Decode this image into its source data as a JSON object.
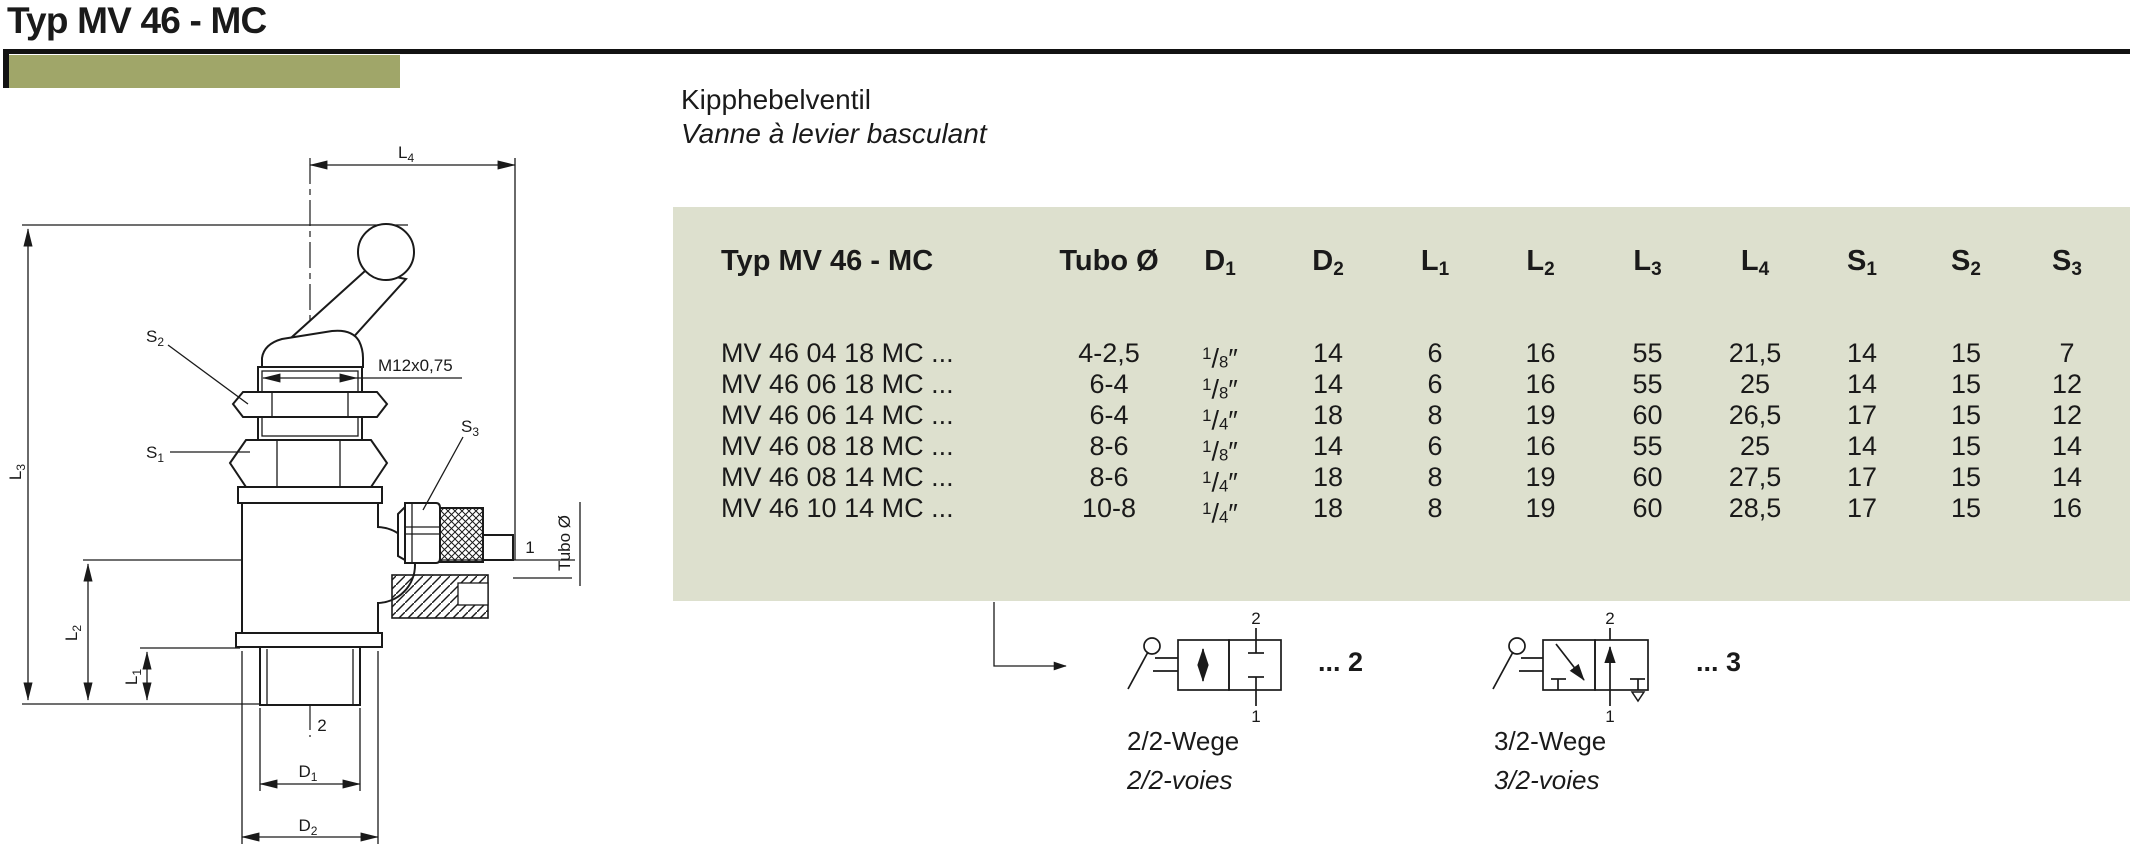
{
  "page": {
    "title": "Typ MV 46 - MC"
  },
  "subtitle": {
    "de": "Kipphebelventil",
    "fr": "Vanne à levier basculant"
  },
  "colors": {
    "accent": "#a0a669",
    "table_bg": "#dde0ce",
    "ink": "#1a1a1a"
  },
  "table": {
    "title": "Typ MV 46 - MC",
    "columns": [
      {
        "label": "Tubo Ø",
        "sub": ""
      },
      {
        "label": "D",
        "sub": "1"
      },
      {
        "label": "D",
        "sub": "2"
      },
      {
        "label": "L",
        "sub": "1"
      },
      {
        "label": "L",
        "sub": "2"
      },
      {
        "label": "L",
        "sub": "3"
      },
      {
        "label": "L",
        "sub": "4"
      },
      {
        "label": "S",
        "sub": "1"
      },
      {
        "label": "S",
        "sub": "2"
      },
      {
        "label": "S",
        "sub": "3"
      }
    ],
    "rows": [
      {
        "code": "MV 46 04 18 MC ...",
        "tubo": "4-2,5",
        "d1": {
          "num": "1",
          "den": "8",
          "unit": "″"
        },
        "d2": "14",
        "l1": "6",
        "l2": "16",
        "l3": "55",
        "l4": "21,5",
        "s1": "14",
        "s2": "15",
        "s3": "7"
      },
      {
        "code": "MV 46 06 18 MC ...",
        "tubo": "6-4",
        "d1": {
          "num": "1",
          "den": "8",
          "unit": "″"
        },
        "d2": "14",
        "l1": "6",
        "l2": "16",
        "l3": "55",
        "l4": "25",
        "s1": "14",
        "s2": "15",
        "s3": "12"
      },
      {
        "code": "MV 46 06 14 MC ...",
        "tubo": "6-4",
        "d1": {
          "num": "1",
          "den": "4",
          "unit": "″"
        },
        "d2": "18",
        "l1": "8",
        "l2": "19",
        "l3": "60",
        "l4": "26,5",
        "s1": "17",
        "s2": "15",
        "s3": "12"
      },
      {
        "code": "MV 46 08 18 MC ...",
        "tubo": "8-6",
        "d1": {
          "num": "1",
          "den": "8",
          "unit": "″"
        },
        "d2": "14",
        "l1": "6",
        "l2": "16",
        "l3": "55",
        "l4": "25",
        "s1": "14",
        "s2": "15",
        "s3": "14"
      },
      {
        "code": "MV 46 08 14 MC ...",
        "tubo": "8-6",
        "d1": {
          "num": "1",
          "den": "4",
          "unit": "″"
        },
        "d2": "18",
        "l1": "8",
        "l2": "19",
        "l3": "60",
        "l4": "27,5",
        "s1": "17",
        "s2": "15",
        "s3": "14"
      },
      {
        "code": "MV 46 10 14 MC ...",
        "tubo": "10-8",
        "d1": {
          "num": "1",
          "den": "4",
          "unit": "″"
        },
        "d2": "18",
        "l1": "8",
        "l2": "19",
        "l3": "60",
        "l4": "28,5",
        "s1": "17",
        "s2": "15",
        "s3": "16"
      }
    ]
  },
  "drawing": {
    "dims": {
      "l4": {
        "base": "L",
        "sub": "4"
      },
      "l3": {
        "base": "L",
        "sub": "3"
      },
      "l2": {
        "base": "L",
        "sub": "2"
      },
      "l1": {
        "base": "L",
        "sub": "1"
      },
      "d1": {
        "base": "D",
        "sub": "1"
      },
      "d2": {
        "base": "D",
        "sub": "2"
      },
      "s1": {
        "base": "S",
        "sub": "1"
      },
      "s2": {
        "base": "S",
        "sub": "2"
      },
      "s3": {
        "base": "S",
        "sub": "3"
      },
      "thread": "M12x0,75",
      "tubo": "Tubo Ø",
      "port_bottom": "2",
      "port_side": "1"
    }
  },
  "symbols": {
    "v22": {
      "port_top": "2",
      "port_bottom": "1",
      "suffix": "... 2",
      "name_de": "2/2-Wege",
      "name_fr": "2/2-voies"
    },
    "v32": {
      "port_top": "2",
      "port_bottom": "1",
      "suffix": "... 3",
      "name_de": "3/2-Wege",
      "name_fr": "3/2-voies"
    }
  }
}
